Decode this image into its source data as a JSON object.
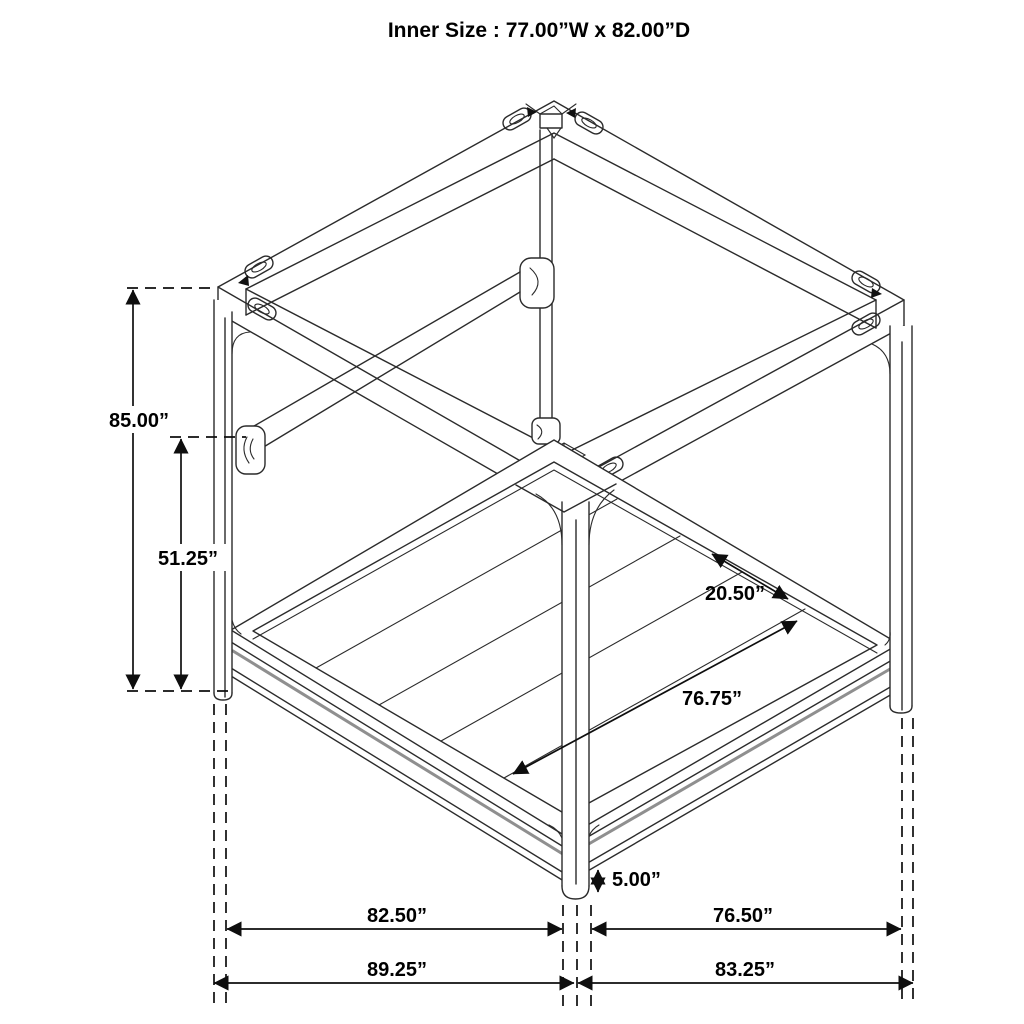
{
  "title": "Inner Size : 77.00”W x 82.00”D",
  "dimensions": {
    "overall_height": "85.00”",
    "rail_height": "51.25”",
    "slat_spacing": "20.50”",
    "slat_span": "76.75”",
    "foot_clearance": "5.00”",
    "side_inner": "82.50”",
    "front_inner": "76.50”",
    "side_outer": "89.25”",
    "front_outer": "83.25”"
  },
  "colors": {
    "ink": "#2b2b2b",
    "dimension": "#0e0e0e",
    "shade": "#8f8f8f",
    "background": "#ffffff"
  }
}
